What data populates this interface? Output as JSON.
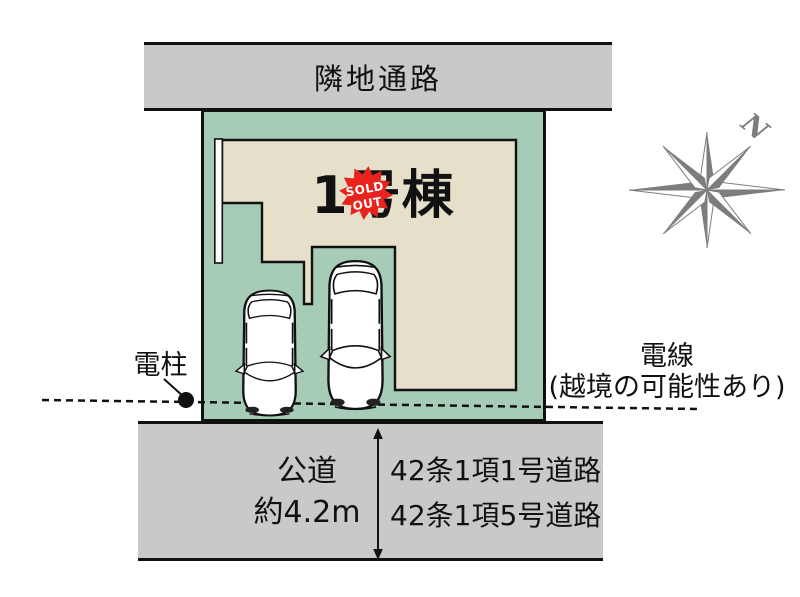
{
  "colors": {
    "plot_green": "#a6cbb7",
    "building_beige": "#e6dfca",
    "road_gray": "#c9c9c9",
    "outline_black": "#111111",
    "sold_out_red": "#e8231d",
    "compass_gray": "#7d7d7d"
  },
  "top_road": {
    "label": "隣地通路"
  },
  "plot": {
    "building_label": "1号棟",
    "sold_out_badge": {
      "line1": "SOLD",
      "line2": "OUT"
    }
  },
  "pole": {
    "label": "電柱"
  },
  "wire": {
    "line1": "電線",
    "line2": "(越境の可能性あり)"
  },
  "bottom_road": {
    "name": "公道",
    "width": "約4.2m",
    "classification_1": "42条1項1号道路",
    "classification_2": "42条1項5号道路"
  },
  "compass": {
    "north_label": "N"
  }
}
